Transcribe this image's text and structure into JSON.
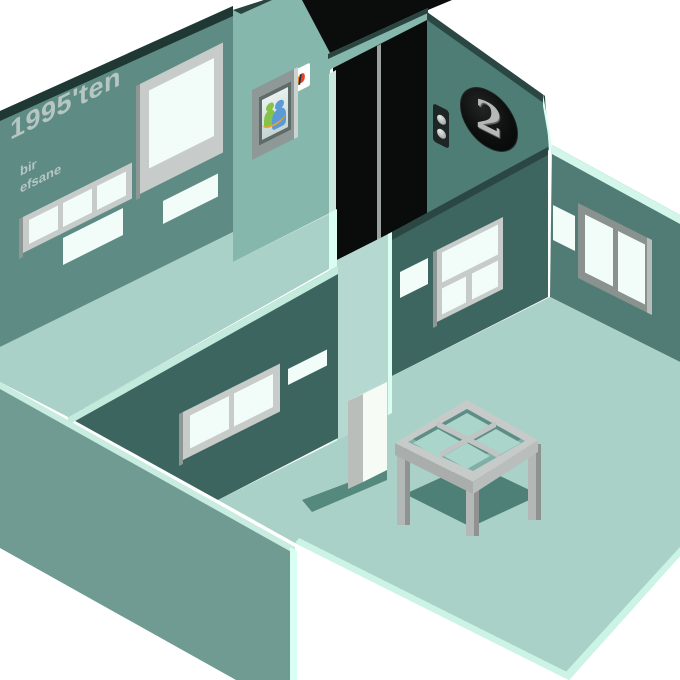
{
  "scene": {
    "wall_banner": {
      "line1": "1995'ten",
      "line2": "bir",
      "line3": "efsane"
    },
    "msn_sign": {
      "text": "msn"
    },
    "floor_sign": {
      "number": "2"
    },
    "objects": {
      "elevator": "elevator with closed black doors",
      "exhibit_picture": "MSN Messenger buddies picture in gray frame",
      "display_table": "table with four open compartments",
      "pedestal": "white display pedestal"
    },
    "palette": {
      "background": "#ffffff",
      "back_wall": "#5e8c85",
      "dark_wall": "#3d6560",
      "exterior_wall": "#6f9b93",
      "elevator_wall": "#86b7ad",
      "floor_number_wall": "#4e7d76",
      "right_wall": "#517c75",
      "floor": "#a9d1c7",
      "mint_edge": "#d9fff3",
      "elevator_doors": "#0a0c0b",
      "window_frame": "#c7ccca",
      "msn_blue": "#14489c",
      "floor_digit_silver": "#b4b9b7"
    }
  }
}
